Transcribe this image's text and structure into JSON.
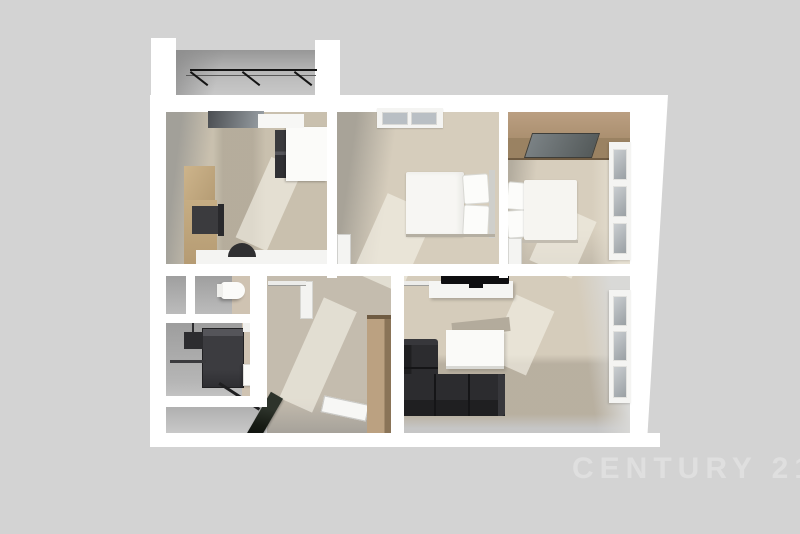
{
  "image": {
    "description": "3D rendered top-down dollhouse floor plan of an apartment on a plain gray backdrop",
    "background_color": "#d3d3d3"
  },
  "watermark": {
    "text": "CENTURY 21.",
    "color": "#dfdfdf"
  },
  "palette": {
    "wall_white": "#ffffff",
    "wall_shadow_gray": "#a2a099",
    "wood_floor_light": "#d6cdbc",
    "wood_floor_dark": "#b4ad9f",
    "gray_floor": "#a5a5a5",
    "wood_furniture": "#b59a74",
    "dark_furniture": "#27272a",
    "window_glass": "#9aa0a4",
    "bedding_white": "#f7f6f3",
    "balcony_railing": "#141414"
  },
  "scene": {
    "rooms": [
      "balcony",
      "kitchen",
      "bedroom-middle",
      "bedroom-right",
      "closet",
      "wc",
      "bathroom",
      "hallway",
      "entry",
      "living-room"
    ],
    "furniture": [
      "balcony-railing",
      "kitchen-counter",
      "cooktop",
      "fridge",
      "kitchen-sink",
      "double-bed",
      "single-bed",
      "wardrobe",
      "toilet",
      "shower",
      "washbasin",
      "towel-bar",
      "hall-wardrobe",
      "shoe-bench",
      "tv",
      "tv-board",
      "coffee-table",
      "corner-sofa"
    ]
  }
}
